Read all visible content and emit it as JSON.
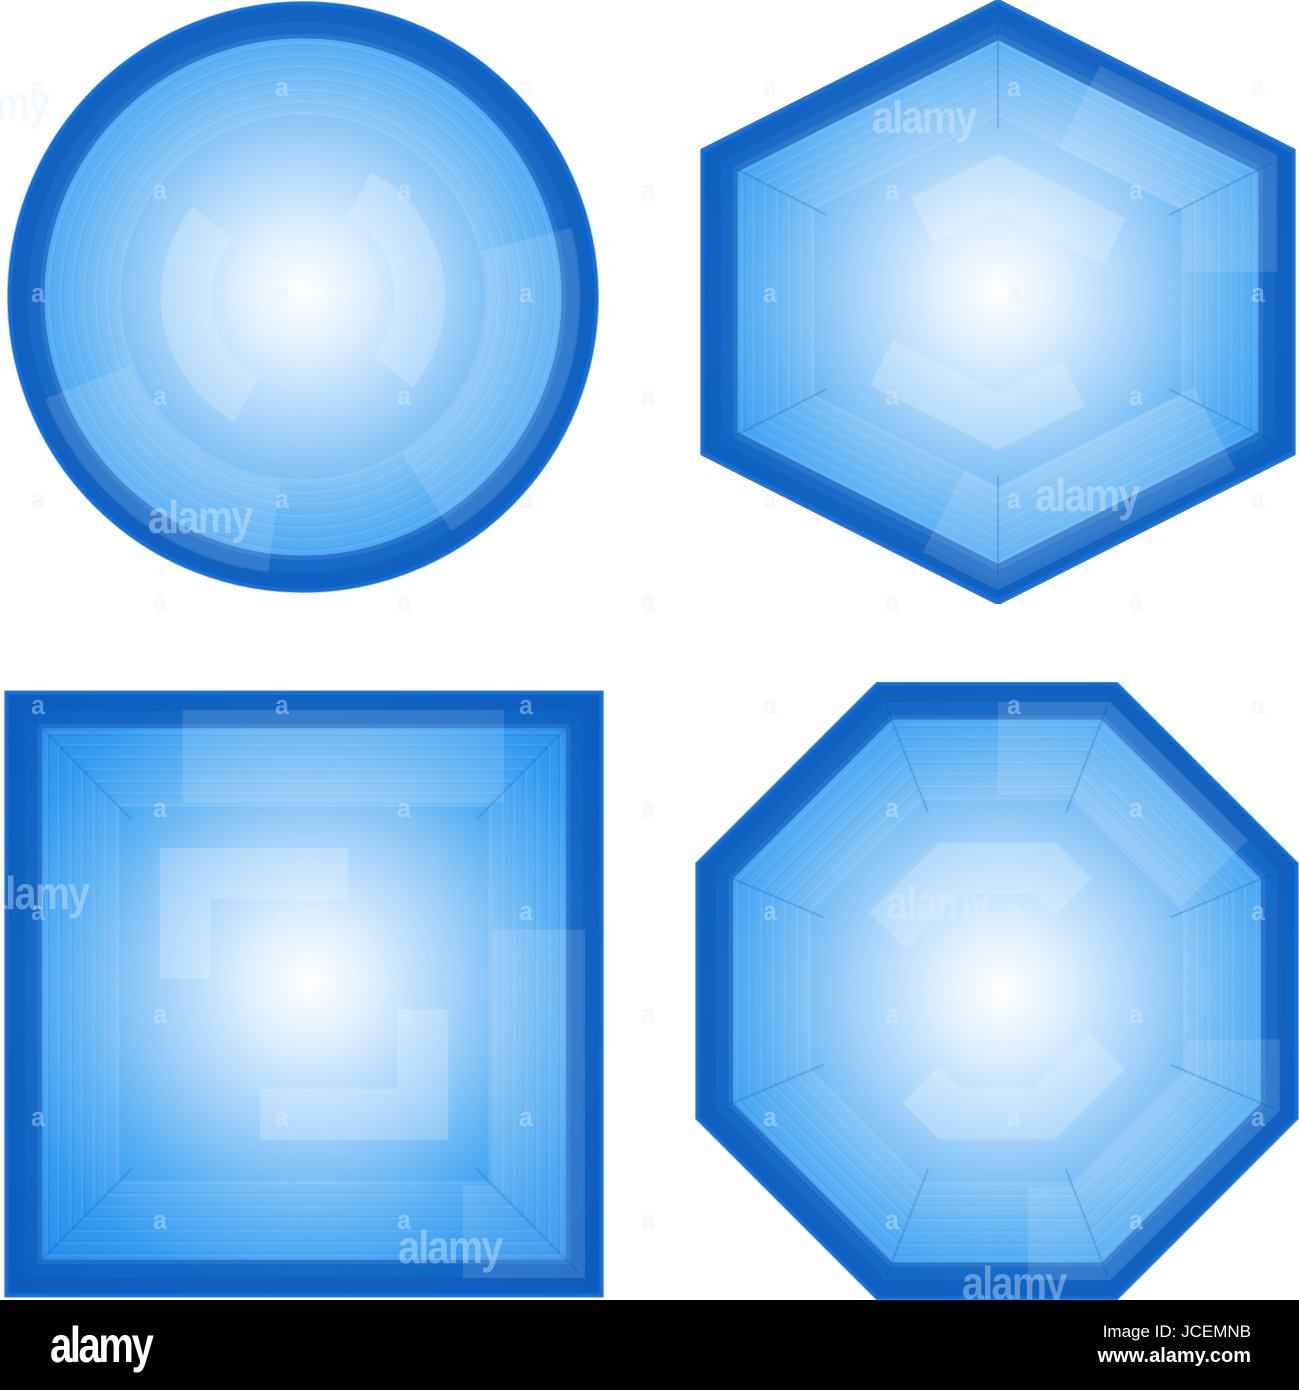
{
  "canvas": {
    "width": 1299,
    "height": 1390,
    "background": "#ffffff"
  },
  "palette": {
    "outline": "#0b72e4",
    "rim_dark": "#0c58b8",
    "rim_deep": "#0a4aa4",
    "ring_stripe": "rgba(255,255,255,0.08)",
    "ring_stripe_bright": "rgba(255,255,255,0.13)",
    "overlay_band": "rgba(255,255,255,0.12)",
    "overlay_bracket": "rgba(255,255,255,0.20)",
    "crease": "rgba(9,70,165,0.20)",
    "glow_stops": [
      [
        "0",
        "#ffffff"
      ],
      [
        "0.13",
        "#ddeefd"
      ],
      [
        "0.30",
        "#9ed0f9"
      ],
      [
        "0.47",
        "#55aef4"
      ],
      [
        "0.62",
        "#2493ef"
      ],
      [
        "0.78",
        "#1480e6"
      ],
      [
        "0.90",
        "#0f6fd6"
      ],
      [
        "1",
        "#0c5abc"
      ]
    ],
    "watermark": "rgba(223,238,252,0.38)"
  },
  "shapes": [
    {
      "name": "circle-gem",
      "kind": "circle",
      "left": 6,
      "top": 1,
      "width": 594,
      "height": 592,
      "cx": 297,
      "cy": 296,
      "r": 293,
      "glow": {
        "fx": 0.5,
        "fy": 0.49
      }
    },
    {
      "name": "hexagon-gem",
      "kind": "polygon",
      "left": 700,
      "top": 0,
      "width": 596,
      "height": 604,
      "points": [
        [
          298,
          3
        ],
        [
          593,
          152
        ],
        [
          593,
          452
        ],
        [
          298,
          601
        ],
        [
          3,
          452
        ],
        [
          3,
          152
        ]
      ],
      "glow": {
        "fx": 0.5,
        "fy": 0.48
      }
    },
    {
      "name": "square-gem",
      "kind": "polygon",
      "left": 4,
      "top": 690,
      "width": 600,
      "height": 608,
      "points": [
        [
          3,
          3
        ],
        [
          597,
          3
        ],
        [
          597,
          605
        ],
        [
          3,
          605
        ]
      ],
      "glow": {
        "fx": 0.51,
        "fy": 0.48
      }
    },
    {
      "name": "octagon-gem",
      "kind": "polygon",
      "left": 695,
      "top": 682,
      "width": 604,
      "height": 618,
      "points": [
        [
          183,
          2
        ],
        [
          421,
          2
        ],
        [
          601,
          182
        ],
        [
          601,
          436
        ],
        [
          421,
          616
        ],
        [
          183,
          616
        ],
        [
          3,
          436
        ],
        [
          3,
          182
        ]
      ],
      "glow": {
        "fx": 0.51,
        "fy": 0.5
      }
    }
  ],
  "watermark": {
    "letter": "a",
    "grid": {
      "x0": 31,
      "y0": 72,
      "step_x": 122,
      "step_y": 103,
      "cols": 11,
      "rows": 13
    },
    "words": [
      {
        "text": "alamy",
        "x": -55,
        "y": 76
      },
      {
        "text": "alamy",
        "x": 872,
        "y": 90
      },
      {
        "text": "alamy",
        "x": 148,
        "y": 490
      },
      {
        "text": "alamy",
        "x": 1035,
        "y": 468
      },
      {
        "text": "alamy",
        "x": -15,
        "y": 866
      },
      {
        "text": "alamy",
        "x": 886,
        "y": 876
      },
      {
        "text": "alamy",
        "x": 398,
        "y": 1220
      },
      {
        "text": "alamy",
        "x": 962,
        "y": 1256
      }
    ]
  },
  "banner": {
    "background": "#000000",
    "text_color": "#ffffff",
    "logo": "alamy",
    "image_id": "Image ID: JCEMNB",
    "url": "www.alamy.com"
  }
}
